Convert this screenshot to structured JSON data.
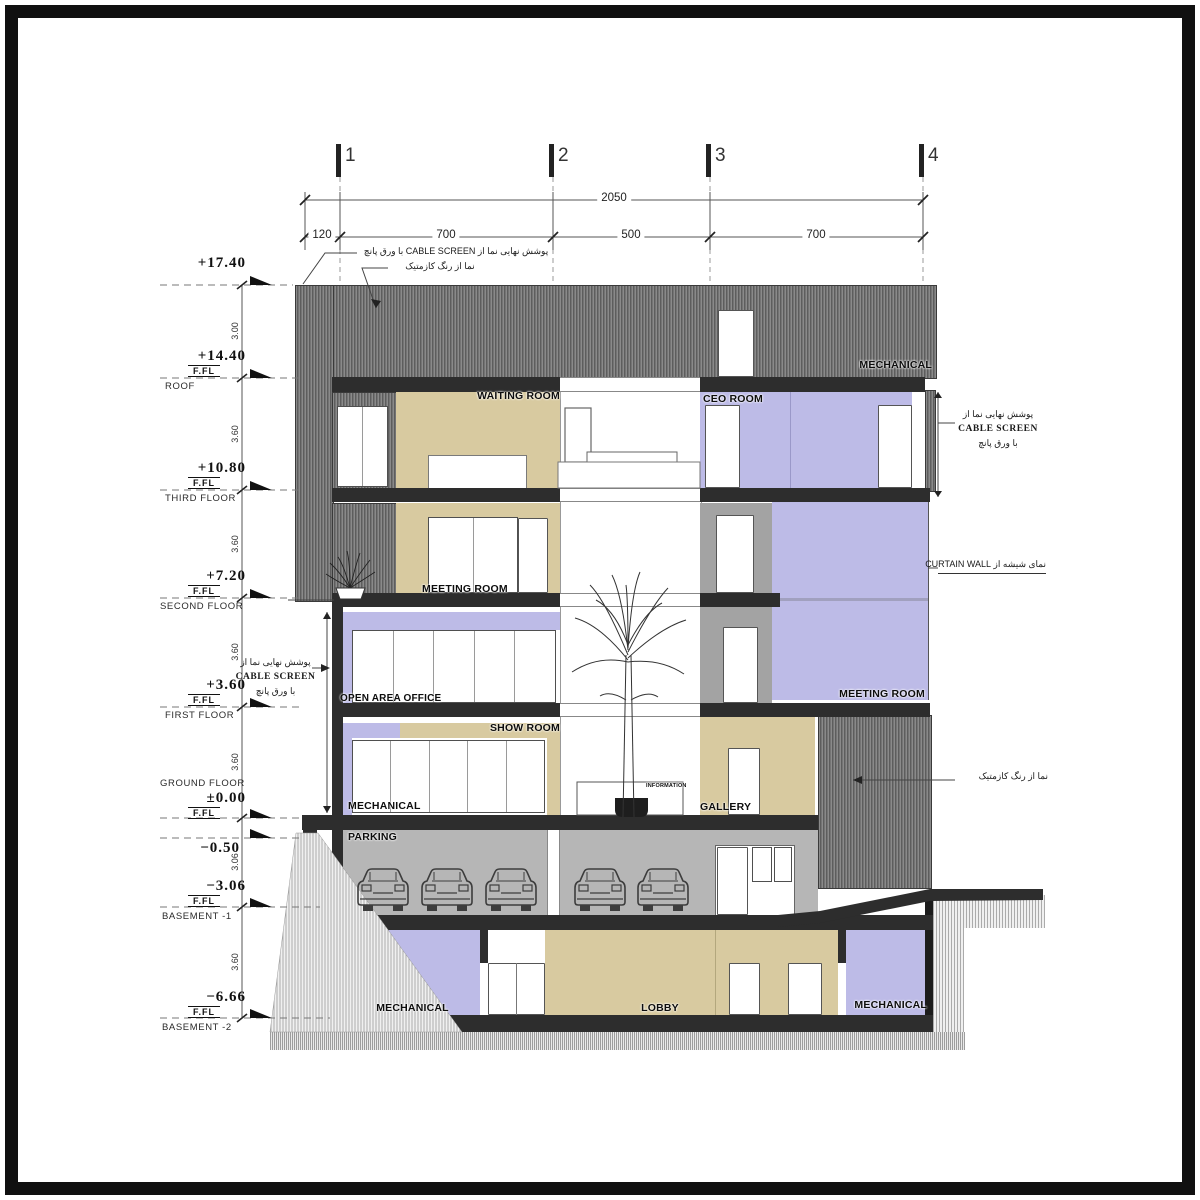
{
  "grid": {
    "axes": [
      "1",
      "2",
      "3",
      "4"
    ],
    "overall_dim": "2050",
    "bay_dims": [
      "120",
      "700",
      "500",
      "700"
    ]
  },
  "levels": [
    {
      "value": "+17.40",
      "ffl": "",
      "name": ""
    },
    {
      "value": "+14.40",
      "ffl": "F.FL",
      "name": "ROOF"
    },
    {
      "value": "+10.80",
      "ffl": "F.FL",
      "name": "THIRD FLOOR"
    },
    {
      "value": "+7.20",
      "ffl": "F.FL",
      "name": "SECOND FLOOR"
    },
    {
      "value": "+3.60",
      "ffl": "F.FL",
      "name": "FIRST FLOOR"
    },
    {
      "value": "±0.00",
      "ffl": "F.FL",
      "name": "GROUND FLOOR"
    },
    {
      "value": "−0.50",
      "ffl": "",
      "name": ""
    },
    {
      "value": "−3.06",
      "ffl": "F.FL",
      "name": "BASEMENT -1"
    },
    {
      "value": "−6.66",
      "ffl": "F.FL",
      "name": "BASEMENT -2"
    }
  ],
  "vertical_dims": [
    "3.00",
    "3.60",
    "3.60",
    "3.60",
    "3.60",
    "3.06",
    "3.60"
  ],
  "rooms": {
    "mechanical_roof": "MECHANICAL",
    "waiting_room": "WAITING ROOM",
    "ceo_room": "CEO ROOM",
    "meeting_room_2f": "MEETING ROOM",
    "open_area_office": "OPEN AREA OFFICE",
    "meeting_room_1f": "MEETING ROOM",
    "show_room": "SHOW ROOM",
    "mechanical_gf": "MECHANICAL",
    "gallery": "GALLERY",
    "information": "INFORMATION",
    "parking": "PARKING",
    "mechanical_b2_left": "MECHANICAL",
    "lobby": "LOBBY",
    "mechanical_b2_right": "MECHANICAL"
  },
  "annotations": {
    "cable_screen_inline": "پوشش نهایی نما از CABLE SCREEN با ورق پانچ",
    "paint_note": "نما از رنگ کازمتیک",
    "cable_screen_l1": "پوشش نهایی نما از",
    "cable_screen_l2": "CABLE SCREEN",
    "cable_screen_l3": "با ورق پانچ",
    "curtain_wall_note": "نمای شیشه از CURTAIN WALL"
  },
  "colors": {
    "tan": "#d8caa0",
    "lavender": "#bdbbe7",
    "slab": "#2d2d2d",
    "screen_gray": "#6e6e6e",
    "parking_gray": "#b6b6b6"
  }
}
